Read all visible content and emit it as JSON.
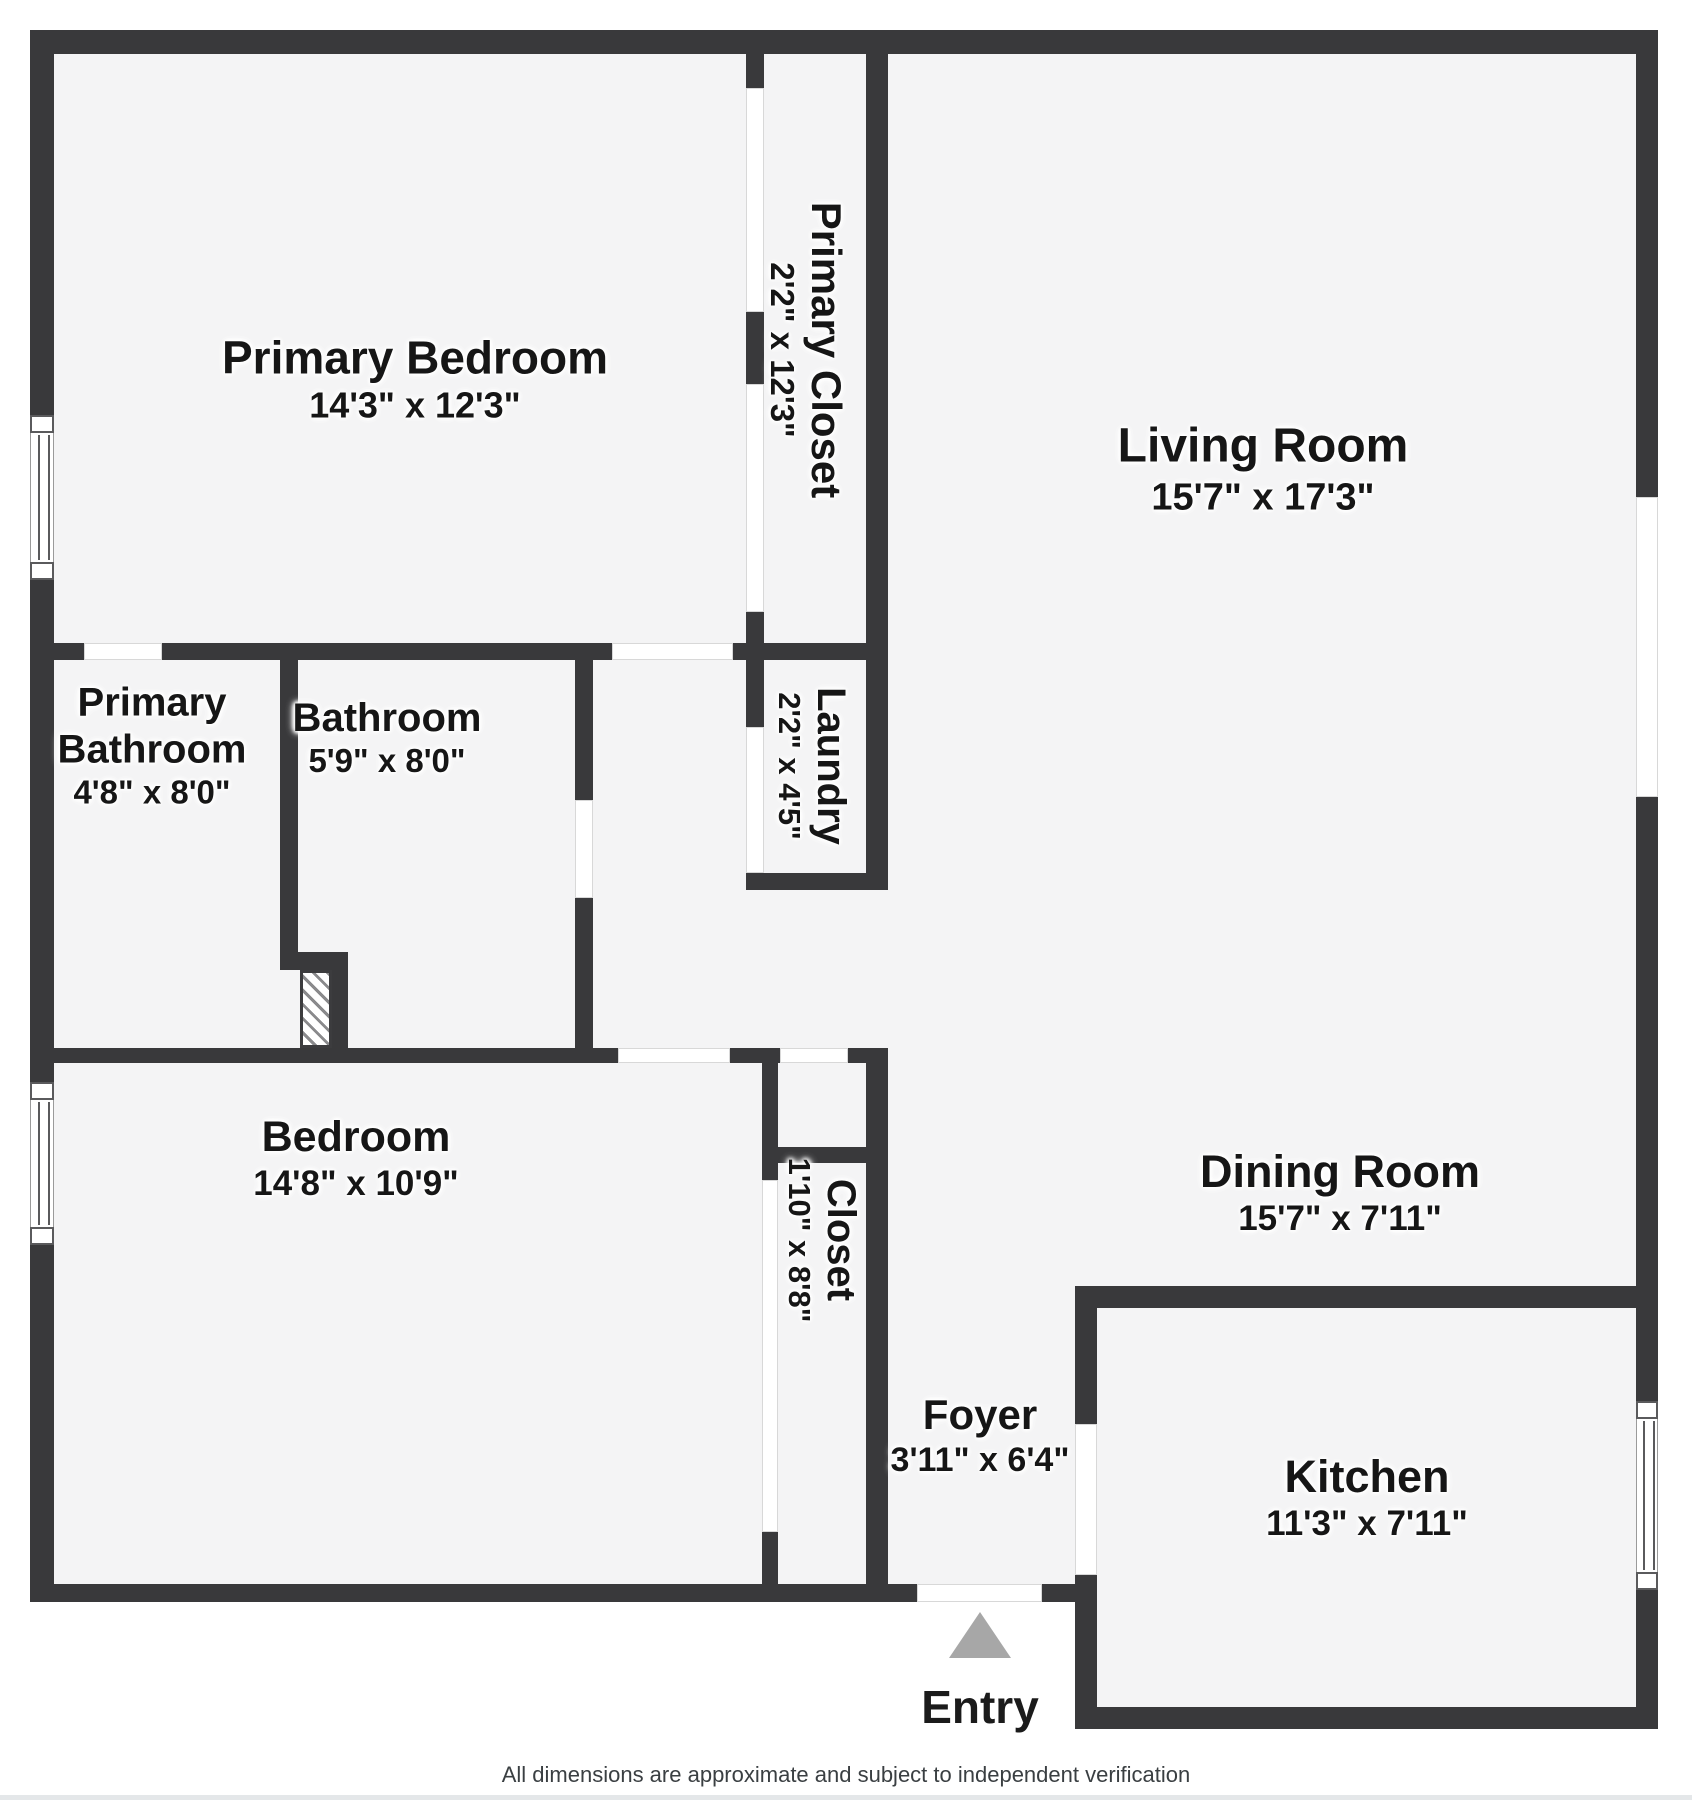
{
  "rooms": {
    "primary_bedroom": {
      "name": "Primary Bedroom",
      "dims": "14'3\" x 12'3\""
    },
    "primary_closet": {
      "name": "Primary Closet",
      "dims": "2'2\" x 12'3\""
    },
    "living_room": {
      "name": "Living Room",
      "dims": "15'7\" x 17'3\""
    },
    "laundry": {
      "name": "Laundry",
      "dims": "2'2\" x 4'5\""
    },
    "primary_bathroom": {
      "name_line1": "Primary",
      "name_line2": "Bathroom",
      "dims": "4'8\" x 8'0\""
    },
    "bathroom": {
      "name": "Bathroom",
      "dims": "5'9\" x 8'0\""
    },
    "bedroom": {
      "name": "Bedroom",
      "dims": "14'8\" x 10'9\""
    },
    "closet": {
      "name": "Closet",
      "dims": "1'10\" x 8'8\""
    },
    "foyer": {
      "name": "Foyer",
      "dims": "3'11\" x 6'4\""
    },
    "dining_room": {
      "name": "Dining Room",
      "dims": "15'7\" x 7'11\""
    },
    "kitchen": {
      "name": "Kitchen",
      "dims": "11'3\" x 7'11\""
    }
  },
  "entry": {
    "label": "Entry"
  },
  "footer": {
    "disclaimer": "All dimensions are approximate and subject to independent verification"
  },
  "colors": {
    "wall": "#39393b",
    "floor": "#f4f4f5",
    "background": "#ffffff",
    "door_opening": "#ffffff",
    "entry_arrow": "#a7a7a7",
    "label_text": "#161616"
  }
}
